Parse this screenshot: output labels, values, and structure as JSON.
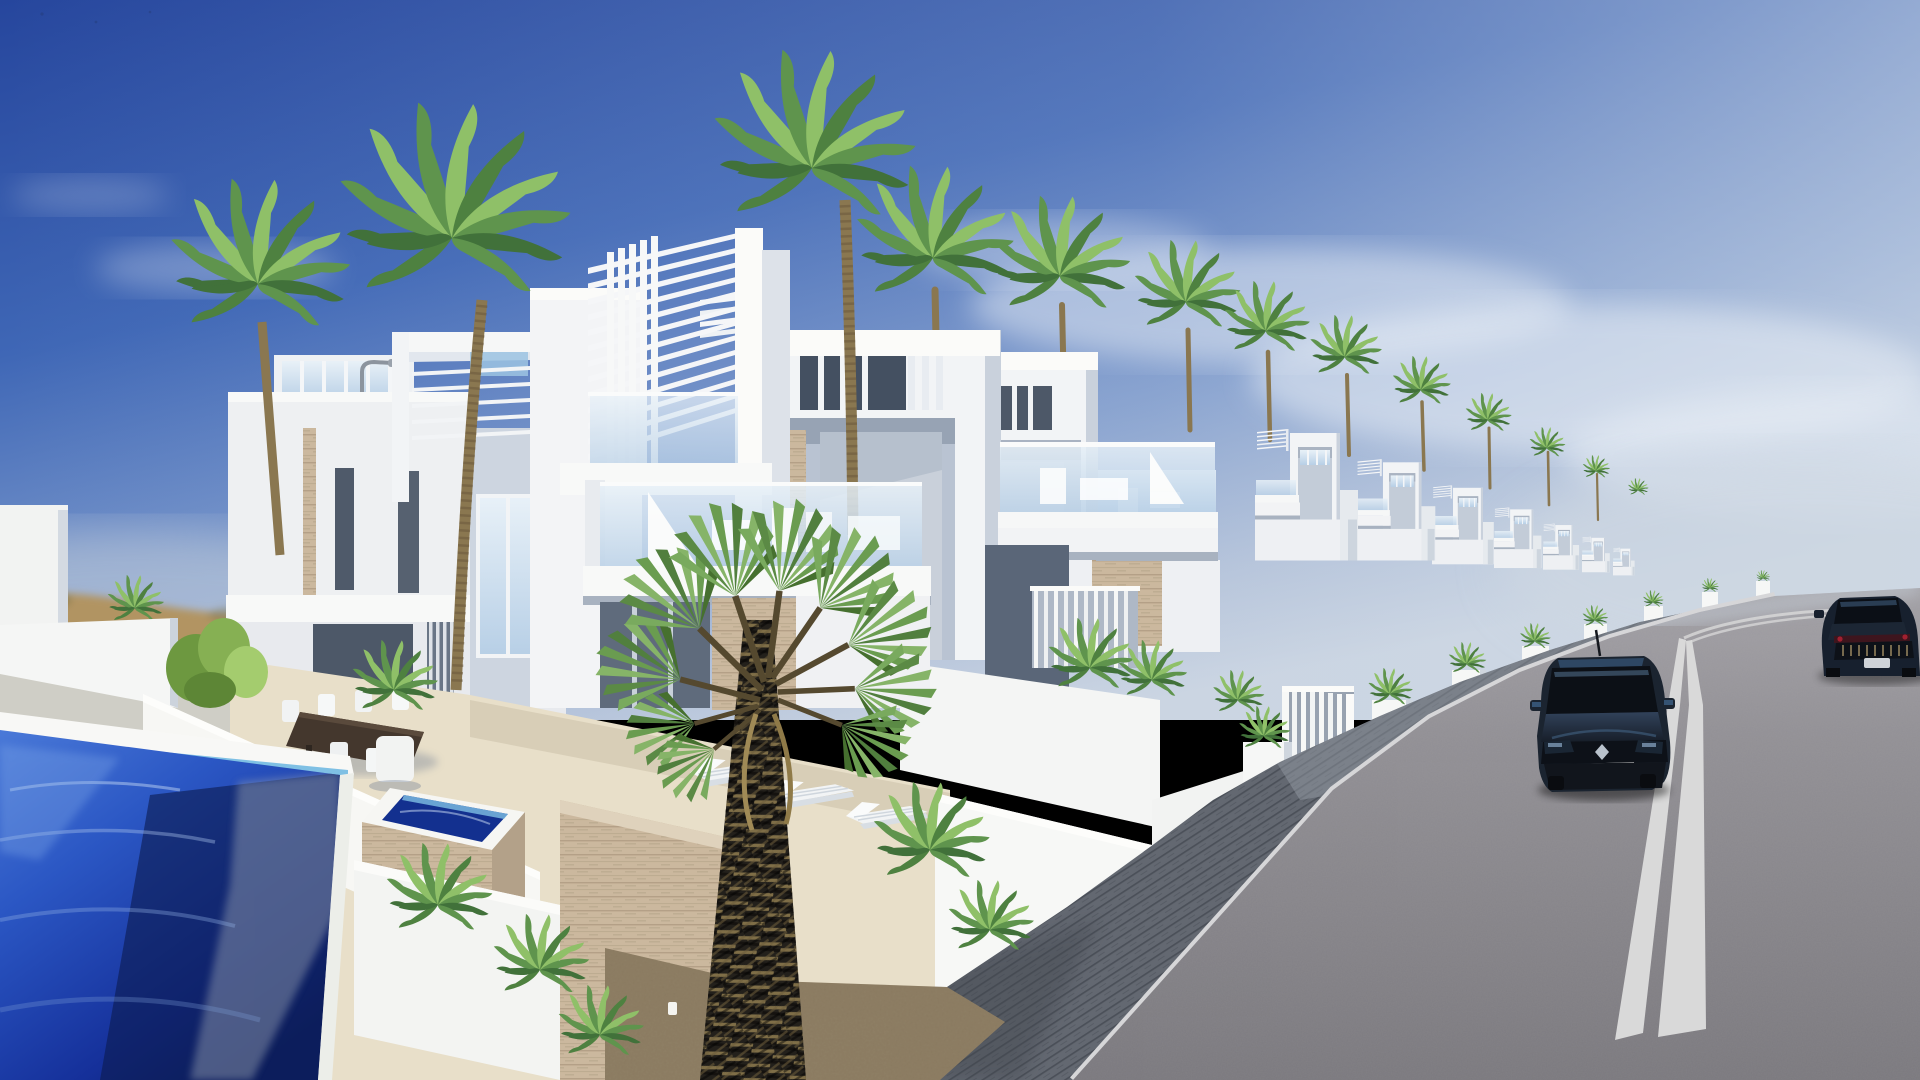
{
  "meta": {
    "type": "3d-architectural-render",
    "width_px": 1920,
    "height_px": 1080
  },
  "labels": {
    "scene_title": "Row of modern white two-storey villas with rooftop pergolas, glass balconies, palm trees and private pools along a curved downhill street with two dark cars"
  },
  "palette": {
    "sky_top": "#26469d",
    "sky_mid": "#3f67b6",
    "sky_low": "#7e9bcd",
    "sky_horizon": "#ccd6e3",
    "cloud": "#e9eff6",
    "dune": "#b2925c",
    "white_sunlit": "#f4f5f6",
    "white_bright": "#fbfbf9",
    "white_shade": "#c6cdd9",
    "white_deep_shade": "#9aa5b5",
    "opening_dark": "#4d5868",
    "glass_light": "#e8f1f8",
    "glass_mid": "#b7cfe6",
    "travertine": "#cbb89e",
    "terrace": "#e8dfc9",
    "pool_light": "#4a79d8",
    "pool_mid": "#2b57c4",
    "pool_deep": "#0e2270",
    "pool_shadow": "#0c1a4e",
    "gravel": "#8a7a60",
    "paver": "#636871",
    "paver_line": "#4b5059",
    "curb": "#d6d6d8",
    "road_far": "#a3a1a6",
    "road_near": "#7b797e",
    "road_line": "#d9d9d9",
    "palm_light": "#8fc068",
    "palm_mid": "#5f944d",
    "palm_dark": "#3e6e36",
    "trunk_tan": "#8a7750",
    "trunk_dark_fiber": "#23201b",
    "car_body": "#1b2430"
  },
  "scene": {
    "time_of_day": "clear sunny midday",
    "weather": "deep blue sky with thin wispy clouds on the right",
    "camera": "elevated three-quarter view looking along the street toward a crest",
    "villas": {
      "count": 9,
      "style": "modern cubic white render, rooftop slat pergolas, vertical louvres, glass balustrade balconies, travertine accent cladding"
    },
    "vegetation": {
      "tall_coconut_palms": 12,
      "foreground_palm": "fan palm with thick dark fibrous trunk",
      "shrubs": "areca palm clumps, green bushes and potted plants"
    },
    "pool": {
      "type": "private plunge pool with raised travertine spa",
      "water": "deep blue with sunlit ripples and wall shadow"
    },
    "street": {
      "sidewalk": "dark grey block paving with pale kerb stone",
      "road": "grey asphalt with double white centre lines",
      "slope": "downhill from foreground to a crest at the right, kerbside white planters with small palms"
    },
    "cars": [
      {
        "name": "dark hatchback with diamond badge, front view, driving toward viewer"
      },
      {
        "name": "dark blue sports coupe, rear view near the crest, cropped by right edge"
      }
    ],
    "horizon": {
      "left": "hazy sandy dunes with low scrub",
      "right": "pale bright haze beyond the road crest"
    }
  }
}
